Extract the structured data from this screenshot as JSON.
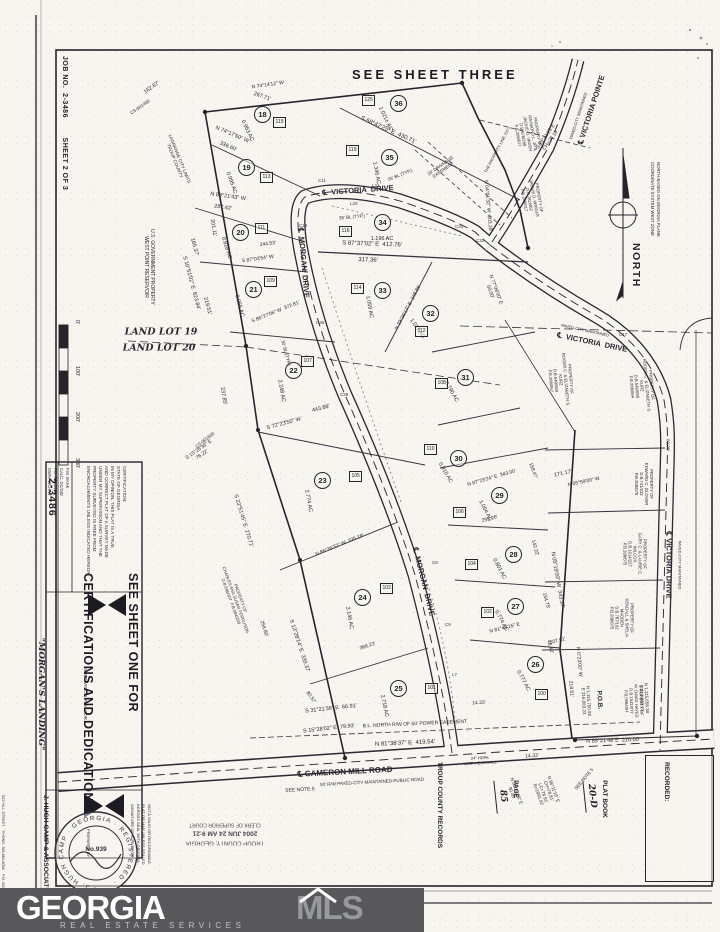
{
  "header": {
    "sheet_three": "SEE SHEET THREE"
  },
  "margin": {
    "job_strip": "JOB NO.  2-3486        SHEET 2 OF 3",
    "scale": [
      "0'",
      "100'",
      "200'",
      "300'"
    ]
  },
  "north": {
    "label": "NORTH",
    "basis": "NORTH BASED ON GEORGIA PLANE\nCOORDINATE SYSTEM WEST ZONE"
  },
  "sidebar": {
    "big_line1": "SEE SHEET ONE FOR",
    "big_line2": "CERTIFICATIONS AND DEDICATIONS",
    "job_number": "2-3486",
    "file_rows": "F.M. BANK\nCALC. DC/DW\nF.B. FOLDER\nDWN. WCH/W",
    "certification": "CERTIFICATION:\nSTATE OF GEORGIA\nIN MY OPINION, THIS PLAT IS A TRUE\nAND CORRECT PLAT OF A SURVEY MADE\nUNDER MY SUPERVISION AND THAT THE\nPROPERTY SURVEYED IS FREE FROM\nENCROACHMENTS UNLESS INDICATED HEREON.",
    "title_block": {
      "tb1": "SUBDIVISION PLAT FOR",
      "tb2": "\"MORGAN'S LANDING\"",
      "tb3": "LOCATED IN",
      "tb4": "LAND LOT(S) 19 & 20       5TH DISTRICT",
      "tb5": "LAGRANGE      TROUP COUNTY      GEORGIA",
      "tb6": "SCALE: 1\"=100' (ORIGINAL)     DATE: 16 JUNE 2004"
    },
    "prepared": {
      "p1": "PREPARED BY",
      "p2": "J. HUGH CAMP & ASSOCIATES",
      "p3": "922 HILL STREET    PHONE: 706-884-6056    P.O. BOX 292",
      "p4": "LAGRANGE      FAX: 706-884-8087      GEORGIA 30241"
    },
    "invalid_note": "NOT A VALID OR RECORDABLE\nPLAT OR MAP UNLESS SEALED\nACROSS SEAL WITH ORIGINAL\nSIGNATURE OF SURVEYOR",
    "seal": {
      "ring": "· J. HUGH CAMP · GEORGIA · REGISTERED ·",
      "number": "No.939"
    }
  },
  "county_stamp": {
    "l1": "TROUP COUNTY, GEORGIA",
    "l2": "2004 JUN 24  AM 9:21",
    "l3": "CLERK OF SUPERIOR COURT"
  },
  "recorded": {
    "title": "RECORDED:",
    "plat_book_label": "PLAT BOOK",
    "plat_book_value": "20-D",
    "page_label": "PAGE",
    "page_value": "85",
    "records_label": "TROUP COUNTY RECORDS"
  },
  "logo": {
    "name1": "GEORGIA",
    "name2": "MLS",
    "tagline": "REAL ESTATE SERVICES"
  },
  "map": {
    "lots": [
      {
        "n": "18",
        "ac": "0.953 AC",
        "x": 262,
        "y": 114,
        "ax": 247,
        "ay": 131,
        "ar": 65
      },
      {
        "n": "19",
        "ac": "0.995 AC",
        "x": 246,
        "y": 167,
        "ax": 231,
        "ay": 183,
        "ar": 70
      },
      {
        "n": "20",
        "ac": "0.818 AC",
        "x": 240,
        "y": 232,
        "ax": 226,
        "ay": 248,
        "ar": 72
      },
      {
        "n": "21",
        "ac": "0.955 AC",
        "x": 253,
        "y": 289,
        "ax": 239,
        "ay": 306,
        "ar": 75
      },
      {
        "n": "22",
        "ac": "2.248 AC",
        "x": 293,
        "y": 370,
        "ax": 281,
        "ay": 391,
        "ar": 80
      },
      {
        "n": "23",
        "ac": "2.774 AC",
        "x": 322,
        "y": 480,
        "ax": 308,
        "ay": 501,
        "ar": 80
      },
      {
        "n": "24",
        "ac": "2.146 AC",
        "x": 362,
        "y": 597,
        "ax": 349,
        "ay": 618,
        "ar": 80
      },
      {
        "n": "25",
        "ac": "2.718 AC",
        "x": 398,
        "y": 688,
        "ax": 384,
        "ay": 706,
        "ar": 78
      },
      {
        "n": "26",
        "ac": "0.777 AC",
        "x": 535,
        "y": 664,
        "ax": 523,
        "ay": 681,
        "ar": 62
      },
      {
        "n": "27",
        "ac": "0.774 AC",
        "x": 515,
        "y": 606,
        "ax": 501,
        "ay": 621,
        "ar": 62
      },
      {
        "n": "28",
        "ac": "0.801 AC",
        "x": 513,
        "y": 554,
        "ax": 499,
        "ay": 569,
        "ar": 62
      },
      {
        "n": "29",
        "ac": "1.004 AC",
        "x": 499,
        "y": 495,
        "ax": 485,
        "ay": 511,
        "ar": 62
      },
      {
        "n": "30",
        "ac": "0.910 AC",
        "x": 458,
        "y": 458,
        "ax": 445,
        "ay": 473,
        "ar": 60
      },
      {
        "n": "31",
        "ac": "0.790 AC",
        "x": 465,
        "y": 377,
        "ax": 451,
        "ay": 392,
        "ar": 60
      },
      {
        "n": "32",
        "ac": "1.017 AC",
        "x": 430,
        "y": 313,
        "ax": 417,
        "ay": 329,
        "ar": 55
      },
      {
        "n": "33",
        "ac": "1.059 AC",
        "x": 382,
        "y": 290,
        "ax": 369,
        "ay": 307,
        "ar": 80
      },
      {
        "n": "34",
        "ac": "1.196 AC",
        "x": 382,
        "y": 222,
        "ax": 382,
        "ay": 239,
        "ar": 0
      },
      {
        "n": "35",
        "ac": "1.346 AC",
        "x": 389,
        "y": 157,
        "ax": 376,
        "ay": 173,
        "ar": 80
      },
      {
        "n": "36",
        "ac": "1.021± AC",
        "x": 398,
        "y": 103,
        "ax": 385,
        "ay": 119,
        "ar": 65
      }
    ],
    "houses": [
      {
        "t": "115",
        "x": 281,
        "y": 122
      },
      {
        "t": "113",
        "x": 268,
        "y": 177
      },
      {
        "t": "111",
        "x": 263,
        "y": 228
      },
      {
        "t": "109",
        "x": 272,
        "y": 281
      },
      {
        "t": "107",
        "x": 309,
        "y": 361
      },
      {
        "t": "105",
        "x": 357,
        "y": 476
      },
      {
        "t": "103",
        "x": 388,
        "y": 588
      },
      {
        "t": "101",
        "x": 433,
        "y": 688
      },
      {
        "t": "100",
        "x": 543,
        "y": 694
      },
      {
        "t": "102",
        "x": 489,
        "y": 612
      },
      {
        "t": "104",
        "x": 473,
        "y": 564
      },
      {
        "t": "106",
        "x": 461,
        "y": 512
      },
      {
        "t": "108",
        "x": 443,
        "y": 383
      },
      {
        "t": "110",
        "x": 432,
        "y": 449
      },
      {
        "t": "112",
        "x": 423,
        "y": 331
      },
      {
        "t": "114",
        "x": 359,
        "y": 288
      },
      {
        "t": "116",
        "x": 347,
        "y": 231
      },
      {
        "t": "119",
        "x": 354,
        "y": 150
      },
      {
        "t": "125",
        "x": 370,
        "y": 100
      }
    ],
    "curve_labels": [
      {
        "t": "C11",
        "x": 318,
        "y": 178
      },
      {
        "t": "L21",
        "x": 372,
        "y": 183
      },
      {
        "t": "L20",
        "x": 350,
        "y": 201
      },
      {
        "t": "C19",
        "x": 299,
        "y": 223
      },
      {
        "t": "C34",
        "x": 455,
        "y": 224
      },
      {
        "t": "C33",
        "x": 476,
        "y": 238
      },
      {
        "t": "C36",
        "x": 316,
        "y": 320
      },
      {
        "t": "C38",
        "x": 340,
        "y": 392
      },
      {
        "t": "C8",
        "x": 432,
        "y": 560
      },
      {
        "t": "C9",
        "x": 445,
        "y": 622
      },
      {
        "t": "L7",
        "x": 452,
        "y": 672
      },
      {
        "t": "C17",
        "x": 619,
        "y": 332
      }
    ],
    "annotations": [
      {
        "t": "℄  VICTORIA  DRIVE",
        "x": 358,
        "y": 191,
        "r": -4,
        "fs": 7.5,
        "b": 1
      },
      {
        "t": "℄  MORGAN  DRIVE",
        "x": 303,
        "y": 263,
        "r": 85,
        "fs": 7.5,
        "b": 1
      },
      {
        "t": "℄  MORGAN  DRIVE",
        "x": 423,
        "y": 582,
        "r": 76,
        "fs": 7.5,
        "b": 1
      },
      {
        "t": "℄  VICTORIA  DRIVE",
        "x": 592,
        "y": 343,
        "r": 12,
        "fs": 7.5,
        "b": 1
      },
      {
        "t": "PAVED-CITY MAINTAINED",
        "x": 585,
        "y": 331,
        "r": 12,
        "fs": 4
      },
      {
        "t": "℄ VICTORIA DRIVE",
        "x": 668,
        "y": 565,
        "r": 90,
        "fs": 7.5,
        "b": 1
      },
      {
        "t": "PAVED-CITY MAINTAINED",
        "x": 679,
        "y": 565,
        "r": 90,
        "fs": 4
      },
      {
        "t": "℄ VICTORIA POINTE",
        "x": 592,
        "y": 110,
        "r": -72,
        "fs": 7.5,
        "b": 1
      },
      {
        "t": "PAVED-CITY MAINTAINED",
        "x": 579,
        "y": 116,
        "r": -72,
        "fs": 4
      },
      {
        "t": "℄ CAMERON MILL ROAD",
        "x": 345,
        "y": 772,
        "r": -3,
        "fs": 8,
        "b": 1
      },
      {
        "t": "50' R/W PAVED-CITY MAINTAINED-PUBLIC ROAD",
        "x": 372,
        "y": 782,
        "r": -3,
        "fs": 4.5
      },
      {
        "t": "LAND LOT 19",
        "x": 161,
        "y": 332,
        "r": 0,
        "fs": 9.5,
        "i": 1
      },
      {
        "t": "LAND LOT 20",
        "x": 159,
        "y": 348,
        "r": 0,
        "fs": 9.5,
        "i": 1
      },
      {
        "t": "U.S. GOVERNMENT PROPERTY\nWEST POINT RESERVOIR",
        "x": 148,
        "y": 267,
        "r": 90,
        "fs": 5
      },
      {
        "t": "LAGRANGE CITY LIMITS\nTROUP COUNTY",
        "x": 177,
        "y": 160,
        "r": 68,
        "fs": 4.5
      },
      {
        "t": "162.67'",
        "x": 152,
        "y": 88,
        "r": -35,
        "fs": 5.5
      },
      {
        "t": "CS-801400",
        "x": 140,
        "y": 107,
        "r": -35,
        "fs": 4.5
      },
      {
        "t": "N 74°14'12\" W",
        "x": 268,
        "y": 86,
        "r": -8,
        "fs": 5
      },
      {
        "t": "267.71'",
        "x": 262,
        "y": 97,
        "r": 20,
        "fs": 5.5
      },
      {
        "t": "N 74°17'50\" W",
        "x": 232,
        "y": 135,
        "r": 23,
        "fs": 5.5
      },
      {
        "t": "336.60'",
        "x": 228,
        "y": 147,
        "r": 23,
        "fs": 5.5
      },
      {
        "t": "201.11'",
        "x": 213,
        "y": 228,
        "r": 80,
        "fs": 5.5
      },
      {
        "t": "N 88°21'43\" W",
        "x": 228,
        "y": 197,
        "r": 8,
        "fs": 5.5
      },
      {
        "t": "287.42'",
        "x": 223,
        "y": 208,
        "r": 8,
        "fs": 5.5
      },
      {
        "t": "244.53'",
        "x": 268,
        "y": 245,
        "r": -8,
        "fs": 5
      },
      {
        "t": "S 87°03'54\" W",
        "x": 258,
        "y": 260,
        "r": -8,
        "fs": 5
      },
      {
        "t": "165.37'",
        "x": 194,
        "y": 247,
        "r": 75,
        "fs": 5.5
      },
      {
        "t": "S 10°51'02\" E  823.84'",
        "x": 191,
        "y": 283,
        "r": 75,
        "fs": 5.5
      },
      {
        "t": "219.51'",
        "x": 207,
        "y": 306,
        "r": 75,
        "fs": 5.5
      },
      {
        "t": "S 86°27'06\" W  372.81'",
        "x": 276,
        "y": 313,
        "r": -22,
        "fs": 5
      },
      {
        "t": "237.85'",
        "x": 223,
        "y": 396,
        "r": 80,
        "fs": 5.5
      },
      {
        "t": "S 72°23'50\" W",
        "x": 284,
        "y": 424,
        "r": -15,
        "fs": 5.5
      },
      {
        "t": "443.88'",
        "x": 321,
        "y": 409,
        "r": -15,
        "fs": 5.5
      },
      {
        "t": "CS-801500",
        "x": 205,
        "y": 440,
        "r": -38,
        "fs": 4.5
      },
      {
        "t": "S 15°28'36\" E\n76.22'",
        "x": 201,
        "y": 453,
        "r": -35,
        "fs": 5
      },
      {
        "t": "S 23°51'45\" E  270.71'",
        "x": 243,
        "y": 521,
        "r": 73,
        "fs": 5.5
      },
      {
        "t": "PROPERTY OF\nCHARLES AND SUSAN FERGUSON\nD.B.546/107  P.B.004/209",
        "x": 235,
        "y": 600,
        "r": 70,
        "fs": 4.2
      },
      {
        "t": "S 13°28'14\" E  339.37'",
        "x": 299,
        "y": 646,
        "r": 72,
        "fs": 5.5
      },
      {
        "t": "256.80'",
        "x": 263,
        "y": 629,
        "r": 72,
        "fs": 5
      },
      {
        "t": "N 86°36'32\" W  335.18'",
        "x": 340,
        "y": 546,
        "r": -22,
        "fs": 5
      },
      {
        "t": "368.23'",
        "x": 368,
        "y": 647,
        "r": -18,
        "fs": 5
      },
      {
        "t": "80.57'",
        "x": 310,
        "y": 698,
        "r": 55,
        "fs": 5
      },
      {
        "t": "S 31°21'36\" E  66.91'",
        "x": 331,
        "y": 709,
        "r": -6,
        "fs": 5.5
      },
      {
        "t": "S 15°28'02\" E  79.93'",
        "x": 329,
        "y": 729,
        "r": -6,
        "fs": 5.5
      },
      {
        "t": "B.L. NORTH R/W OF 50' POWER EASEMENT",
        "x": 415,
        "y": 725,
        "r": -2.5,
        "fs": 5
      },
      {
        "t": "N 81°38'37\" E  419.54'",
        "x": 405,
        "y": 744,
        "r": -2.5,
        "fs": 6
      },
      {
        "t": "SEE NOTE 5",
        "x": 300,
        "y": 791,
        "r": -3,
        "fs": 5
      },
      {
        "t": "24\" HDPE\nW/SR HEADWALL",
        "x": 480,
        "y": 761,
        "r": -3,
        "fs": 4
      },
      {
        "t": "14.33'",
        "x": 479,
        "y": 704,
        "r": -3,
        "fs": 5
      },
      {
        "t": "14.33'",
        "x": 532,
        "y": 757,
        "r": -3,
        "fs": 5
      },
      {
        "t": "N 86°11'15\" E\nCH=78.81'\nLC=78.91'\nR=1991.91'",
        "x": 546,
        "y": 792,
        "r": 70,
        "fs": 4.5
      },
      {
        "t": "N 83°23'06\" E\n90.45'",
        "x": 514,
        "y": 792,
        "r": 70,
        "fs": 4.5
      },
      {
        "t": "SEE NOTE 5",
        "x": 584,
        "y": 779,
        "r": -50,
        "fs": 4.5
      },
      {
        "t": "P.O.B.",
        "x": 599,
        "y": 700,
        "r": 87,
        "fs": 6.5,
        "b": 1
      },
      {
        "t": "N 1,115,700.92\nE 216,083.23",
        "x": 586,
        "y": 701,
        "r": 87,
        "fs": 4.5
      },
      {
        "t": "N 1,115,658.38\nE 213,863.23",
        "x": 644,
        "y": 698,
        "r": 87,
        "fs": 4.5
      },
      {
        "t": "N 89°21'48\"E  220.00'",
        "x": 613,
        "y": 741,
        "r": -2,
        "fs": 5.5
      },
      {
        "t": "218.51'",
        "x": 570,
        "y": 689,
        "r": 85,
        "fs": 5
      },
      {
        "t": "N 0°23'00\" W",
        "x": 578,
        "y": 662,
        "r": 85,
        "fs": 5
      },
      {
        "t": "207.51'",
        "x": 558,
        "y": 642,
        "r": -14,
        "fs": 5
      },
      {
        "t": "N 81°43'15\" E",
        "x": 505,
        "y": 629,
        "r": -14,
        "fs": 5
      },
      {
        "t": "48.40'",
        "x": 549,
        "y": 647,
        "r": 75,
        "fs": 5
      },
      {
        "t": "154.75'",
        "x": 545,
        "y": 601,
        "r": 75,
        "fs": 5
      },
      {
        "t": "N 05°19'00\" W  343.37'",
        "x": 557,
        "y": 580,
        "r": 80,
        "fs": 5.5
      },
      {
        "t": "142.22'",
        "x": 534,
        "y": 548,
        "r": 75,
        "fs": 5
      },
      {
        "t": "295.26'",
        "x": 490,
        "y": 520,
        "r": -15,
        "fs": 5
      },
      {
        "t": "N 87°23'24\" E  343.00'",
        "x": 492,
        "y": 479,
        "r": -16,
        "fs": 5
      },
      {
        "t": "158.47'",
        "x": 532,
        "y": 471,
        "r": 70,
        "fs": 5
      },
      {
        "t": "171.17'",
        "x": 563,
        "y": 474,
        "r": -12,
        "fs": 5.5
      },
      {
        "t": "N 05°59'00\" W",
        "x": 584,
        "y": 483,
        "r": -12,
        "fs": 5
      },
      {
        "t": "60.00'",
        "x": 668,
        "y": 445,
        "r": 90,
        "fs": 4.5
      },
      {
        "t": "PROPERTY OF\nEDWARD C. GLOVER\nD.B.741/232\nP.B.208/075",
        "x": 643,
        "y": 484,
        "r": 90,
        "fs": 4.2
      },
      {
        "t": "PROPERTY OF\nGARY C. & LAURIE C.\nWILCOX\nD.B.1014/227\nP.B.208/075",
        "x": 634,
        "y": 554,
        "r": 90,
        "fs": 4.2
      },
      {
        "t": "PROPERTY OF\nKENDALL & SHELIA\nMADDEN\nD.B.787/162\nP.B.208/075",
        "x": 621,
        "y": 618,
        "r": 90,
        "fs": 4.2
      },
      {
        "t": "PROPERTY OF\nM. DAVID HAYES\nD.B.1542/077\nP.B.098/097",
        "x": 633,
        "y": 701,
        "r": 88,
        "fs": 4.2
      },
      {
        "t": "PROPERTY OF\nROGER C. & ELIZABETH S.\nKURZ\nD.B.549/659\nP.B.200/057",
        "x": 560,
        "y": 380,
        "r": 85,
        "fs": 4.2
      },
      {
        "t": "PROPERTY OF\nROGER C. & ELIZABETH S.\nKURZ\nD.B.549/659\nP.B.208/054",
        "x": 641,
        "y": 386,
        "r": 85,
        "fs": 4.2
      },
      {
        "t": "PROPERTY OF\nRAYMOND L. JR &\nJACKIE D. VADEN\nD.B.676/298\nP.B.208/017",
        "x": 527,
        "y": 134,
        "r": 80,
        "fs": 4.2
      },
      {
        "t": "PROPERTY OF\nJACKIE D. WRIGHT\nD.B.782/462\nP.B.208/017",
        "x": 531,
        "y": 199,
        "r": 80,
        "fs": 4.2
      },
      {
        "t": "THE PROPERTY LINE 707'±",
        "x": 498,
        "y": 150,
        "r": -62,
        "fs": 4
      },
      {
        "t": "S 68°47'25\" E  430.71'",
        "x": 388,
        "y": 131,
        "r": 24,
        "fs": 6
      },
      {
        "t": "20' DRAINAGE\nEASEMENT",
        "x": 442,
        "y": 168,
        "r": -35,
        "fs": 4.5
      },
      {
        "t": "25' BL (TYP.)",
        "x": 400,
        "y": 175,
        "r": -22,
        "fs": 4.5
      },
      {
        "t": "35' BL (TYP.)",
        "x": 352,
        "y": 217,
        "r": -5,
        "fs": 4.5
      },
      {
        "t": "30' BL (TYP.)",
        "x": 286,
        "y": 353,
        "r": 75,
        "fs": 4.5
      },
      {
        "t": "S 87°37'02\" E  412.76'",
        "x": 372,
        "y": 245,
        "r": 2,
        "fs": 6
      },
      {
        "t": "317.36'",
        "x": 368,
        "y": 261,
        "r": 2,
        "fs": 6
      },
      {
        "t": "N 39°36'17\" E  248.86'",
        "x": 409,
        "y": 308,
        "r": -62,
        "fs": 5
      },
      {
        "t": "N 04°01'32\" W  203.28'",
        "x": 487,
        "y": 206,
        "r": 85,
        "fs": 5
      },
      {
        "t": "S 16°41'25\"E\nCH=27.18'",
        "x": 549,
        "y": 139,
        "r": -55,
        "fs": 5
      },
      {
        "t": "N 77°09'00\" E\n50.00'",
        "x": 492,
        "y": 291,
        "r": 70,
        "fs": 5
      }
    ]
  }
}
